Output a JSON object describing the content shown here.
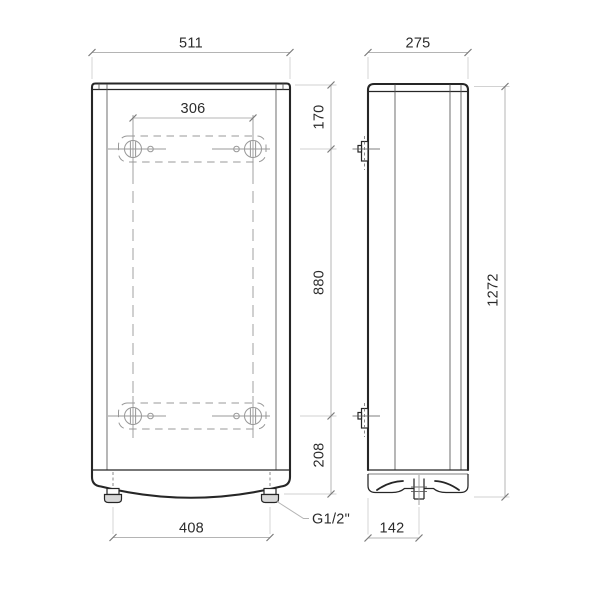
{
  "colors": {
    "outline": "#262626",
    "secondary": "#555555",
    "dimension": "#b4b4b4",
    "centerline": "#989898",
    "text": "#2b2b2b",
    "background": "#ffffff"
  },
  "front_view": {
    "width_top": "511",
    "mount_width": "306",
    "top_offset": "170",
    "mount_spacing": "880",
    "bottom_offset": "208",
    "bottom_width": "408",
    "connection_label": "G1/2\""
  },
  "side_view": {
    "depth_top": "275",
    "height": "1272",
    "depth_bottom": "142"
  }
}
